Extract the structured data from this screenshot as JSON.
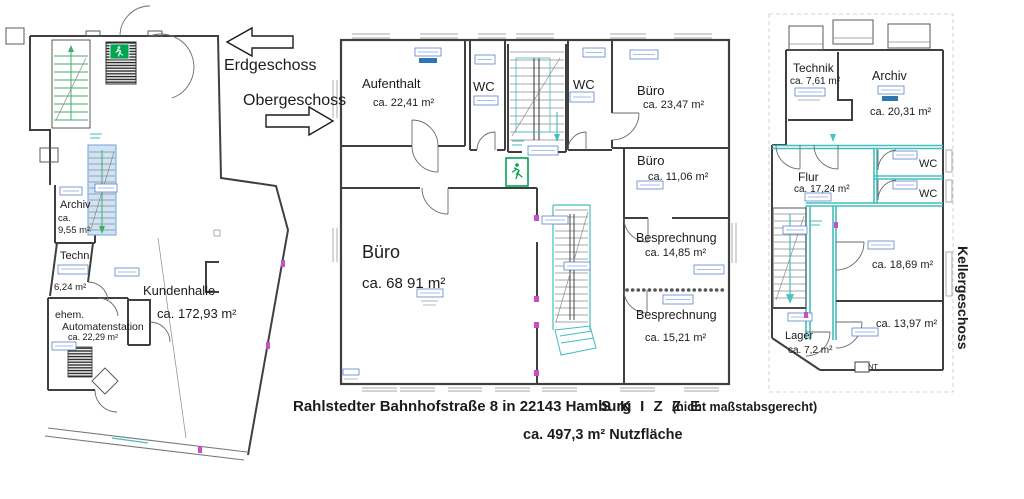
{
  "document_type": "floor-plan-sketch",
  "floors": {
    "erdgeschoss": {
      "label": "Erdgeschoss",
      "rooms": {
        "archiv": {
          "name": "Archiv",
          "area_line1": "ca.",
          "area_line2": "9,55 m²"
        },
        "technik": {
          "name": "Techn.",
          "area": "6,24 m²"
        },
        "kundenhalle": {
          "name": "Kundenhalle",
          "area": "ca. 172,93 m²"
        },
        "automatenstation": {
          "name_line1": "ehem.",
          "name_line2": "Automatenstation",
          "area": "ca. 22,29 m²"
        }
      }
    },
    "obergeschoss": {
      "label": "Obergeschoss",
      "rooms": {
        "aufenthalt": {
          "name": "Aufenthalt",
          "area": "ca. 22,41 m²"
        },
        "wc_links": {
          "name": "WC"
        },
        "wc_rechts": {
          "name": "WC"
        },
        "buero_gross": {
          "name": "Büro",
          "area": "ca. 68 91 m²"
        },
        "buero_oben": {
          "name": "Büro",
          "area": "ca. 23,47 m²"
        },
        "buero_klein": {
          "name": "Büro",
          "area": "ca. 11,06 m²"
        },
        "besprechung_1": {
          "name": "Besprechnung",
          "area": "ca. 14,85 m²"
        },
        "besprechung_2": {
          "name": "Besprechnung",
          "area": "ca. 15,21 m²"
        }
      }
    },
    "kellergeschoss": {
      "label": "Kellergeschoss",
      "rooms": {
        "technik": {
          "name": "Technik",
          "area": "ca. 7,61 m²"
        },
        "archiv": {
          "name": "Archiv",
          "area": "ca. 20,31 m²"
        },
        "flur": {
          "name": "Flur",
          "area": "ca. 17,24 m²"
        },
        "wc_oben": {
          "name": "WC"
        },
        "wc_unten": {
          "name": "WC"
        },
        "raum_gross": {
          "area": "ca. 18,69 m²"
        },
        "raum_klein": {
          "area": "ca. 13,97 m²"
        },
        "lager": {
          "name": "Lager",
          "area": "ca. 7,2 m²"
        },
        "nt": {
          "label": "NT"
        }
      }
    }
  },
  "footer": {
    "address": "Rahlstedter Bahnhofstraße 8 in 22143 Hamburg",
    "skizze": "S K I Z Z E",
    "skizze_note": "(nicht maßstabsgerecht)",
    "total_area": "ca. 497,3 m² Nutzfläche"
  },
  "colors": {
    "wall": "#3f3f3f",
    "teal_stair": "#45bdbd",
    "cyan_basement_wall": "#45c6c6",
    "exit_sign_green": "#00a551",
    "label_blue": "#4472c4",
    "label_bar_blue": "#2e75b6",
    "stair_highlight_fill": "#cfe3f5",
    "stair_green": "#3fae6a",
    "marker_magenta": "#c84ec8"
  }
}
